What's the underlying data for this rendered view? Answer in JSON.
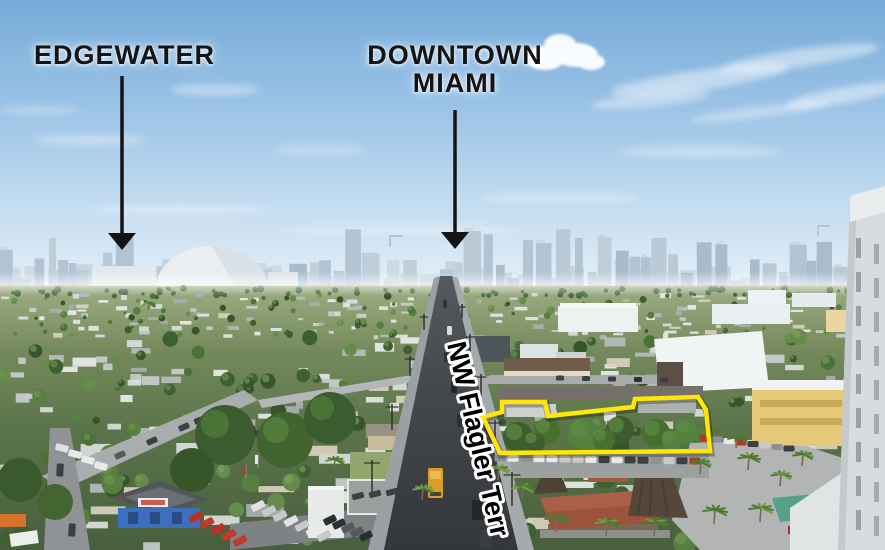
{
  "scene": {
    "type": "annotated-aerial-photograph",
    "description": "Aerial drone photo looking toward the Downtown Miami skyline with neighborhood labels, a street name along the road, and a property parcel outlined in yellow",
    "area_labels": [
      {
        "id": "edgewater",
        "text": "EDGEWATER"
      },
      {
        "id": "downtown",
        "text_line1": "DOWNTOWN",
        "text_line2": "MIAMI"
      }
    ],
    "street_label": {
      "text": "NW Flagler Terr"
    },
    "visible_landmarks": [
      "city-skyline",
      "stadium-dome",
      "residential-sprawl",
      "nw-flagler-terr-road",
      "highlighted-parcel",
      "parcel-tree-row",
      "car-dealership-lot",
      "red-tile-roof-restaurant",
      "tiki-thatch-roofs",
      "palm-trees",
      "white-warehouses",
      "yellow-apartment-building",
      "foreground-white-tower"
    ],
    "colors": {
      "annotation": "#141414",
      "parcel_outline": "#ffe604",
      "street_text_fill": "#000000",
      "street_text_stroke": "#ffffff",
      "sky_top": "#76abd8",
      "sky_horizon": "#e9f2f8",
      "skyline_haze": "#b2c4d2",
      "road_asphalt": "#3b3f43",
      "vegetation": "#4a7238",
      "dealership_blue": "#3c6fbe",
      "restaurant_roof": "#9c523c",
      "school_bus": "#d79f28"
    }
  }
}
